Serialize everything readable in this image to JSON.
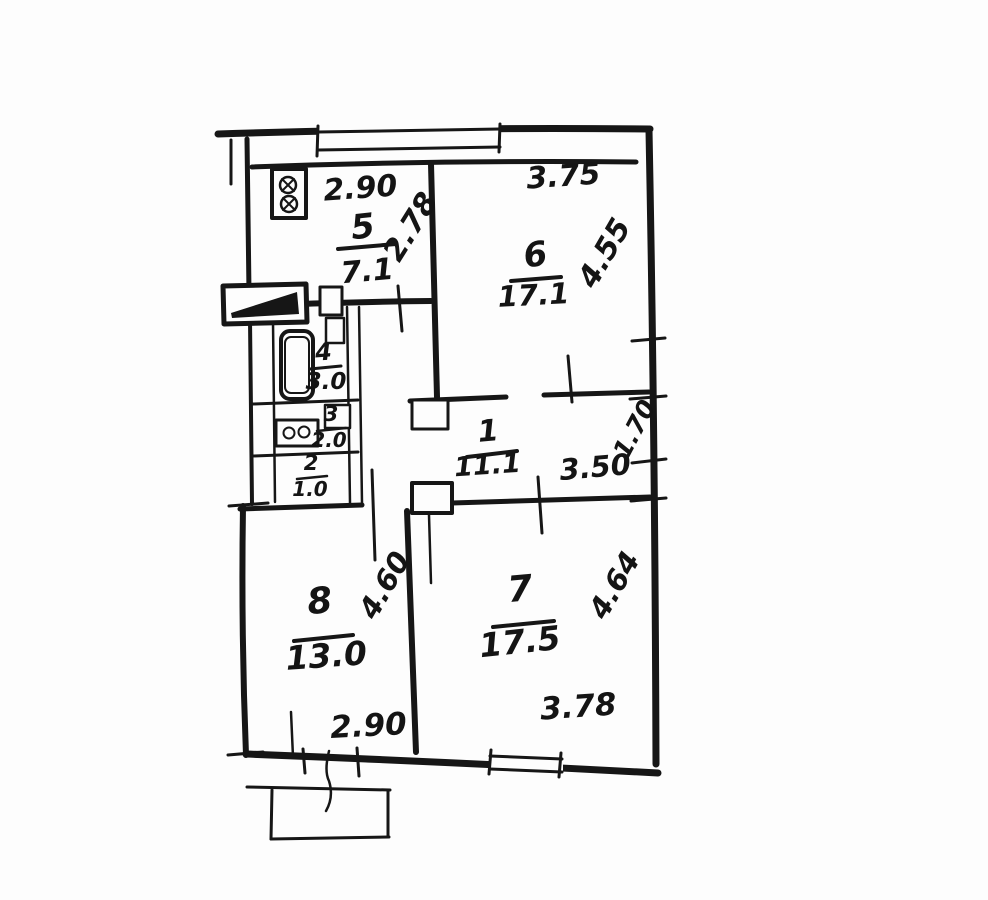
{
  "floorplan": {
    "ink_color": "#161616",
    "paper_color": "#fdfdfd",
    "rooms": {
      "room5": {
        "number": "5",
        "area": "7.1",
        "dim_width": "2.90",
        "dim_height": "2.78"
      },
      "room6": {
        "number": "6",
        "area": "17.1",
        "dim_width": "3.75",
        "dim_height": "4.55"
      },
      "room4": {
        "number": "4",
        "area": "3.0"
      },
      "room3": {
        "number": "3",
        "area": "2.0"
      },
      "room2": {
        "number": "2",
        "area": "1.0"
      },
      "room1": {
        "number": "1",
        "area": "11.1",
        "dim_width": "3.50",
        "dim_height": "1.70"
      },
      "room8": {
        "number": "8",
        "area": "13.0",
        "dim_width": "2.90",
        "dim_height": "4.60"
      },
      "room7": {
        "number": "7",
        "area": "17.5",
        "dim_width": "3.78",
        "dim_height": "4.64"
      }
    }
  }
}
